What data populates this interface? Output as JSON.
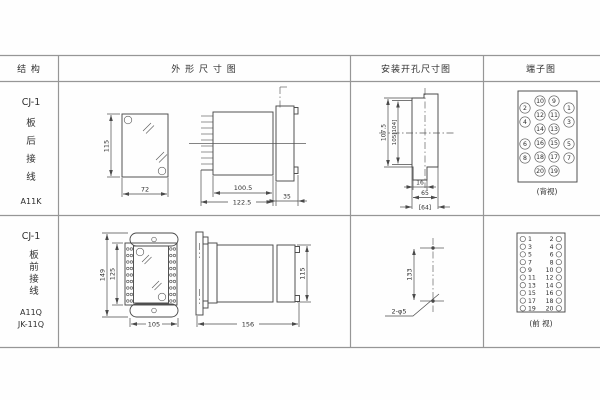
{
  "header": {
    "structure": "结 构",
    "outline": "外 形 尺 寸 图",
    "mounting": "安装开孔尺寸图",
    "terminal": "端子图"
  },
  "row1": {
    "model": "CJ-1",
    "wiring": [
      "板",
      "后",
      "接",
      "线"
    ],
    "code": "A11K",
    "dims": {
      "height": "115",
      "width": "72",
      "body": "100.5",
      "total": "122.5",
      "flange": "35",
      "cut_h": "107.5",
      "cut_h2": "105[104]",
      "notch": "16",
      "cut_w": "65",
      "cut_w2": "[64]"
    },
    "term": {
      "view": "(背视)",
      "grid": [
        [
          "2",
          "10",
          "9",
          "1"
        ],
        [
          "4",
          "12",
          "11",
          "3"
        ],
        [
          "14",
          "13"
        ],
        [
          "6",
          "16",
          "15",
          "5"
        ],
        [
          "8",
          "18",
          "17",
          "7"
        ],
        [
          "20",
          "19"
        ]
      ]
    }
  },
  "row2": {
    "model": "CJ-1",
    "wiring": [
      "板",
      "前",
      "接",
      "线"
    ],
    "codes": [
      "A11Q",
      "JK-11Q"
    ],
    "dims": {
      "outer_h": "149",
      "inner_h": "125",
      "width": "105",
      "length": "156",
      "height": "115",
      "spacing": "133",
      "holes": "2-φ5"
    },
    "term": {
      "view": "(前 视)",
      "left": [
        "1",
        "3",
        "5",
        "7",
        "9",
        "11",
        "13",
        "15",
        "17",
        "19"
      ],
      "right": [
        "2",
        "4",
        "6",
        "8",
        "10",
        "12",
        "14",
        "16",
        "18",
        "20"
      ]
    }
  }
}
